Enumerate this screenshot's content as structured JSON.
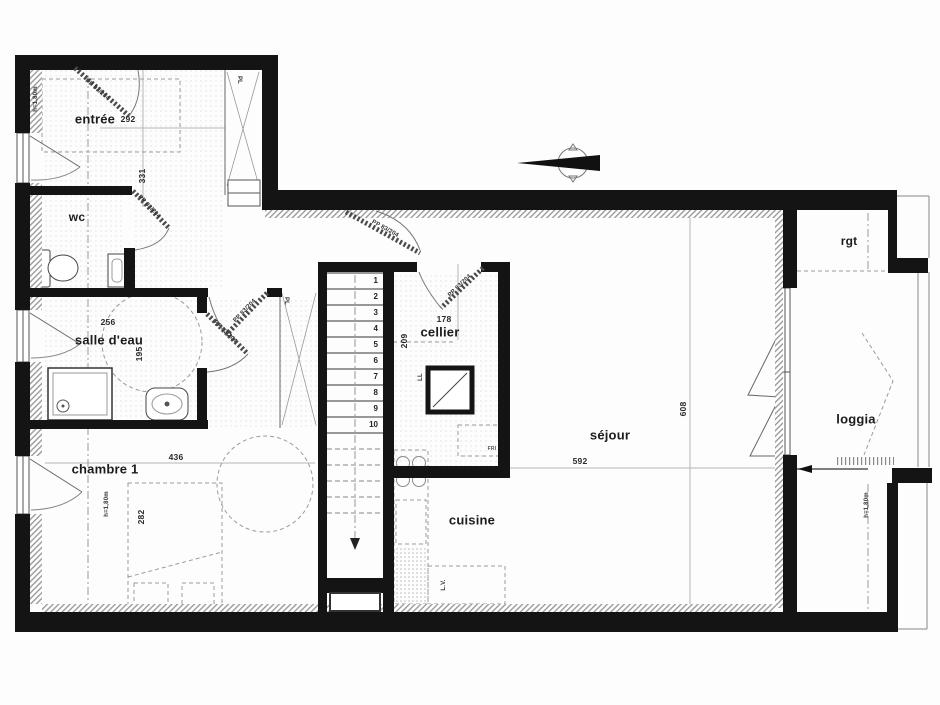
{
  "plan": {
    "rooms": {
      "entree": {
        "name": "entrée",
        "width": "292",
        "depth": "331"
      },
      "wc": {
        "name": "wc"
      },
      "salle_deau": {
        "name": "salle d'eau",
        "width": "256",
        "depth": "195"
      },
      "chambre1": {
        "name": "chambre 1",
        "width": "436",
        "depth": "282"
      },
      "cellier": {
        "name": "cellier",
        "width": "178",
        "depth": "209"
      },
      "sejour": {
        "name": "séjour",
        "width": "592",
        "depth": "608"
      },
      "cuisine": {
        "name": "cuisine"
      },
      "loggia": {
        "name": "loggia"
      },
      "rgt": {
        "name": "rgt"
      }
    },
    "doors": {
      "entrance": "PP 93/204",
      "interior": "PP 83/204"
    },
    "labels": {
      "closet": "PL",
      "window_height": "h=1,80m",
      "washing_machine": "LL",
      "dishwasher": "L.V.",
      "fridge": "FRI"
    },
    "stairs": {
      "steps": [
        "1",
        "2",
        "3",
        "4",
        "5",
        "6",
        "7",
        "8",
        "9",
        "10"
      ]
    },
    "colors": {
      "wall": "#141414",
      "line": "#3a3a3a",
      "guide": "#9a9a9a"
    }
  }
}
